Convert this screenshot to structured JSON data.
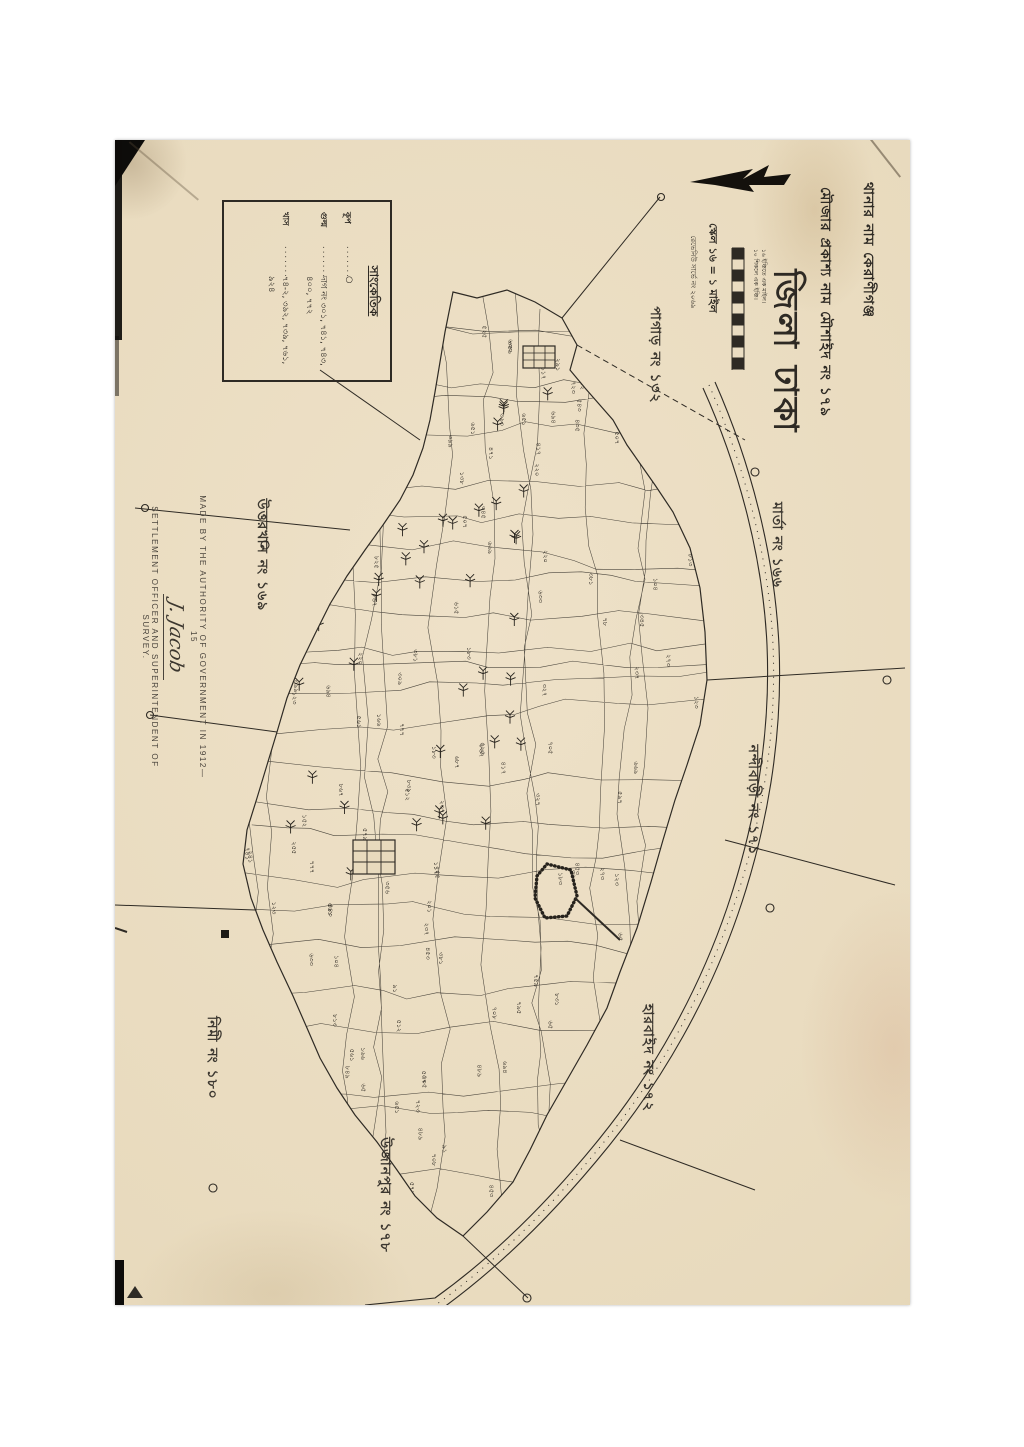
{
  "sheet": {
    "ink_color": "#2e2a24",
    "paper_color": "#e8dabd",
    "title_block": {
      "thana_line": "থানার নাম কেরাণীগঞ্জ",
      "mouza_line": "মৌজার প্রকাশ্য নাম মৌশাইদ নং ১৭৯",
      "district_line": "জিলা ঢাকা",
      "scale_line": "স্কেল ১৬ = ১ মাইল",
      "revenue_line": "রেভেনিউ সার্ভে নং ২০৬৯",
      "scale_bar_notes": [
        "১৬ ইঞ্চিতে এক মাইল।",
        "১০ শিকলে এক ইঞ্চি।"
      ]
    },
    "legend": {
      "title": "সাংকেতিক",
      "entries": [
        {
          "label": "কূপ",
          "value": "○"
        },
        {
          "label": "গুল্ম",
          "value": "দাগ নং ৩০১, ৭৪১, ৭৪৩, ৪০০, ৭৭২"
        },
        {
          "label": "খাস",
          "value": "৭৪-২, ৩৯২, ৭৩৯, ৭৬১, ৯২৪"
        }
      ]
    },
    "attribution": {
      "line1": "MADE BY THE AUTHORITY OF GOVERNMENT IN 1912—15",
      "signature": "J. Jacob",
      "line2": "SETTLEMENT OFFICER AND SUPERINTENDENT OF SURVEY."
    },
    "neighbors": [
      {
        "name": "পাগাড় নং ১৩২"
      },
      {
        "name": "মার্তা নং ১৬৬"
      },
      {
        "name": "উত্তরখান নং ১৬৯"
      },
      {
        "name": "নন্দীবাড়ী নং ১৭১"
      },
      {
        "name": "হারবাইদ নং ১৭২"
      },
      {
        "name": "নিমী নং ১৮০"
      },
      {
        "name": "উজানপুর নং ১৭৮"
      }
    ],
    "plot_numbers": [
      "৬৫",
      "১২৩",
      "২৪১",
      "৭৮",
      "২২০",
      "৩৫৬",
      "৫১২",
      "৬৯৪",
      "৭০৮",
      "৮২৫",
      "৯১",
      "১০৪",
      "১১৭",
      "১৩৮",
      "১৫২",
      "১৬৬",
      "১৮৩",
      "২০১",
      "২১৯",
      "২৩৭",
      "২৫৫",
      "২৭৩",
      "২৯১",
      "৩০৯",
      "৩২৭",
      "৩৪৫",
      "৩৬৩",
      "৩৮১",
      "৩৯৯",
      "৪১৭",
      "৪৩৫",
      "৪৫৩",
      "৪৭১",
      "৪৮৯",
      "৫০৭",
      "৫২৫",
      "৫৪৩",
      "৫৬১",
      "৫৭৯",
      "৫৯৭",
      "৬১৫",
      "৬৩৩",
      "৬৫১",
      "৬৬৯",
      "৬৮৭",
      "৭০৫",
      "৭২৩",
      "৭৪১",
      "৭৫৯",
      "৭৭৭",
      "৭৯৫",
      "৮১৩",
      "৮৩১",
      "৮৪৯",
      "৮৬৭",
      "৮৮৫"
    ]
  }
}
